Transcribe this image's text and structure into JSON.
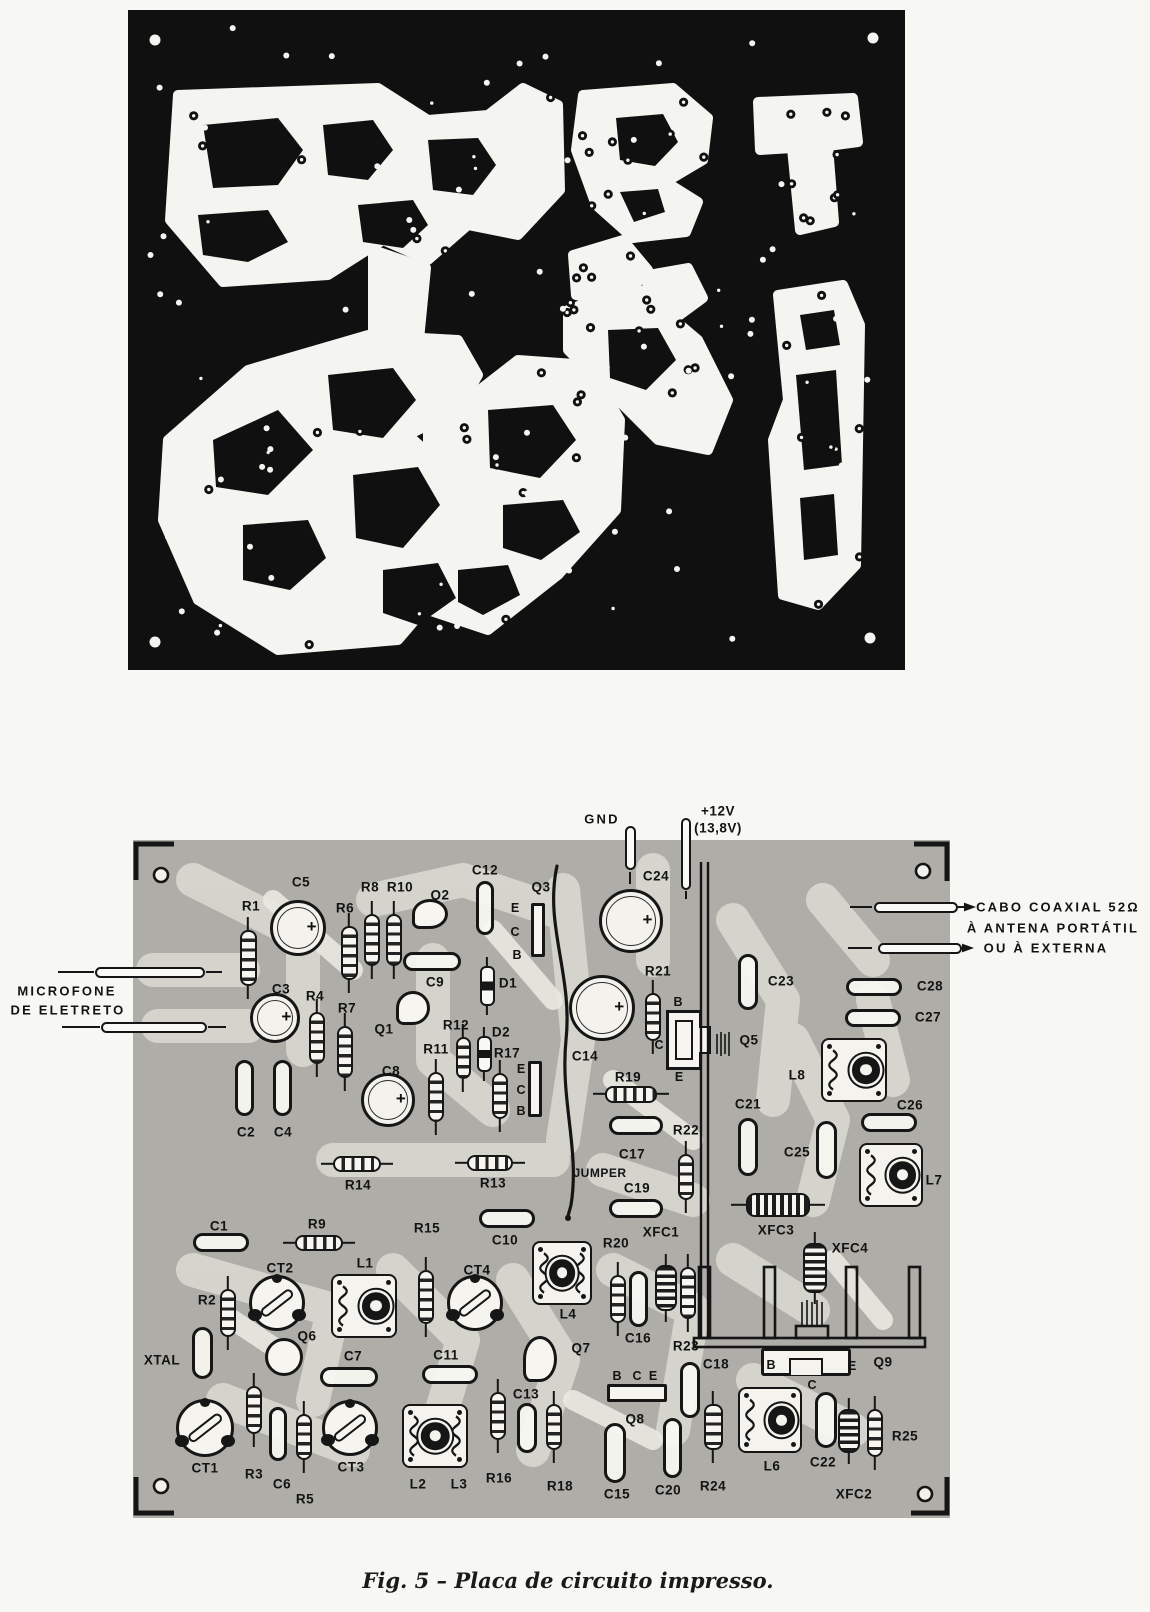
{
  "figure": {
    "caption": "Fig. 5 – Placa de circuito impresso."
  },
  "colors": {
    "pcb_black": "#101010",
    "trace_white": "#f4f4f0",
    "board_gray": "#aeada7",
    "ghost_trace": "#d9d8d1",
    "ink": "#161616",
    "paper": "#f7f7f4"
  },
  "annotations": {
    "ground": "GND",
    "supply": "+12V",
    "supply_alt": "(13,8V)",
    "microphone_line1": "MICROFONE",
    "microphone_line2": "DE ELETRETO",
    "coax_line1": "CABO COAXIAL 52Ω",
    "coax_line2": "À ANTENA PORTÁTIL",
    "coax_line3": "OU À EXTERNA",
    "jumper": "JUMPER",
    "crystal": "XTAL"
  },
  "board": {
    "components": [
      {
        "label": "R1",
        "type": "resistor-v",
        "x": 248,
        "y": 958,
        "w": 17,
        "h": 56,
        "lx": 251,
        "ly": 906
      },
      {
        "label": "C5",
        "type": "cap-el",
        "x": 298,
        "y": 928,
        "w": 56,
        "h": 56,
        "lx": 301,
        "ly": 882
      },
      {
        "label": "R6",
        "type": "resistor-v",
        "x": 349,
        "y": 953,
        "w": 17,
        "h": 54,
        "lx": 345,
        "ly": 908
      },
      {
        "label": "R8",
        "type": "resistor-v",
        "x": 372,
        "y": 940,
        "w": 16,
        "h": 52,
        "lx": 370,
        "ly": 887
      },
      {
        "label": "R10",
        "type": "resistor-v",
        "x": 394,
        "y": 940,
        "w": 16,
        "h": 52,
        "lx": 400,
        "ly": 887
      },
      {
        "label": "Q2",
        "type": "transistor",
        "x": 430,
        "y": 914,
        "w": 36,
        "h": 30,
        "lx": 440,
        "ly": 895
      },
      {
        "label": "C12",
        "type": "cap-sm-v",
        "x": 485,
        "y": 908,
        "w": 18,
        "h": 54,
        "lx": 485,
        "ly": 870
      },
      {
        "label": "Q3",
        "type": "q-rect-v",
        "x": 538,
        "y": 930,
        "w": 14,
        "h": 54,
        "lx": 541,
        "ly": 887
      },
      {
        "label": "C9",
        "type": "cap-sm-h",
        "x": 432,
        "y": 961,
        "w": 58,
        "h": 19,
        "lx": 435,
        "ly": 982
      },
      {
        "label": "D1",
        "type": "diode-v",
        "x": 487,
        "y": 986,
        "w": 15,
        "h": 40,
        "lx": 508,
        "ly": 983
      },
      {
        "label": "Q1",
        "type": "transistor",
        "x": 413,
        "y": 1008,
        "w": 34,
        "h": 34,
        "lx": 384,
        "ly": 1029
      },
      {
        "label": "C3",
        "type": "cap-el",
        "x": 275,
        "y": 1018,
        "w": 50,
        "h": 50,
        "lx": 281,
        "ly": 989
      },
      {
        "label": "R4",
        "type": "resistor-v",
        "x": 317,
        "y": 1038,
        "w": 16,
        "h": 52,
        "lx": 315,
        "ly": 996
      },
      {
        "label": "R7",
        "type": "resistor-v",
        "x": 345,
        "y": 1052,
        "w": 16,
        "h": 52,
        "lx": 347,
        "ly": 1008
      },
      {
        "label": "R12",
        "type": "resistor-v",
        "x": 463,
        "y": 1058,
        "w": 15,
        "h": 42,
        "lx": 456,
        "ly": 1025
      },
      {
        "label": "D2",
        "type": "diode-v",
        "x": 484,
        "y": 1054,
        "w": 15,
        "h": 36,
        "lx": 501,
        "ly": 1032
      },
      {
        "label": "R11",
        "type": "resistor-v",
        "x": 436,
        "y": 1097,
        "w": 16,
        "h": 50,
        "lx": 436,
        "ly": 1049
      },
      {
        "label": "R17",
        "type": "resistor-v",
        "x": 500,
        "y": 1096,
        "w": 16,
        "h": 46,
        "lx": 507,
        "ly": 1053
      },
      {
        "label": "",
        "id": "q4-outline",
        "type": "q-rect-v",
        "x": 535,
        "y": 1089,
        "w": 14,
        "h": 56
      },
      {
        "label": "C8",
        "type": "cap-el",
        "x": 388,
        "y": 1100,
        "w": 54,
        "h": 54,
        "lx": 391,
        "ly": 1071
      },
      {
        "label": "C2",
        "type": "cap-sm-v",
        "x": 244,
        "y": 1088,
        "w": 19,
        "h": 56,
        "lx": 246,
        "ly": 1132
      },
      {
        "label": "C4",
        "type": "cap-sm-v",
        "x": 282,
        "y": 1088,
        "w": 19,
        "h": 56,
        "lx": 283,
        "ly": 1132
      },
      {
        "label": "R14",
        "type": "resistor-h",
        "x": 357,
        "y": 1164,
        "w": 48,
        "h": 16,
        "lx": 358,
        "ly": 1185
      },
      {
        "label": "R13",
        "type": "resistor-h",
        "x": 490,
        "y": 1163,
        "w": 46,
        "h": 16,
        "lx": 493,
        "ly": 1183
      },
      {
        "label": "C24",
        "type": "cap-el",
        "x": 631,
        "y": 921,
        "w": 64,
        "h": 64,
        "lx": 656,
        "ly": 876
      },
      {
        "label": "C14",
        "type": "cap-el",
        "x": 602,
        "y": 1008,
        "w": 66,
        "h": 66,
        "lx": 585,
        "ly": 1056
      },
      {
        "label": "R21",
        "type": "resistor-v",
        "x": 653,
        "y": 1017,
        "w": 16,
        "h": 48,
        "lx": 658,
        "ly": 971
      },
      {
        "label": "R19",
        "type": "resistor-h",
        "x": 631,
        "y": 1094,
        "w": 52,
        "h": 17,
        "lx": 628,
        "ly": 1077
      },
      {
        "label": "C23",
        "type": "cap-sm-v",
        "x": 748,
        "y": 982,
        "w": 20,
        "h": 56,
        "lx": 781,
        "ly": 981
      },
      {
        "label": "C28",
        "type": "cap-sm-h",
        "x": 874,
        "y": 987,
        "w": 56,
        "h": 18,
        "lx": 930,
        "ly": 986
      },
      {
        "label": "C27",
        "type": "cap-sm-h",
        "x": 873,
        "y": 1018,
        "w": 56,
        "h": 18,
        "lx": 928,
        "ly": 1017
      },
      {
        "label": "L8",
        "type": "coil-can",
        "x": 854,
        "y": 1070,
        "w": 66,
        "h": 64,
        "lx": 797,
        "ly": 1075
      },
      {
        "label": "C26",
        "type": "cap-sm-h",
        "x": 889,
        "y": 1122,
        "w": 56,
        "h": 19,
        "lx": 910,
        "ly": 1105
      },
      {
        "label": "C21",
        "type": "cap-sm-v",
        "x": 748,
        "y": 1147,
        "w": 20,
        "h": 58,
        "lx": 748,
        "ly": 1104
      },
      {
        "label": "C25",
        "type": "cap-sm-v",
        "x": 826,
        "y": 1150,
        "w": 21,
        "h": 58,
        "lx": 797,
        "ly": 1152
      },
      {
        "label": "L7",
        "type": "coil-can",
        "x": 891,
        "y": 1175,
        "w": 64,
        "h": 64,
        "lx": 934,
        "ly": 1180
      },
      {
        "label": "C17",
        "type": "cap-sm-h",
        "x": 636,
        "y": 1125,
        "w": 54,
        "h": 19,
        "lx": 632,
        "ly": 1154
      },
      {
        "label": "JUMPER",
        "lx": 600,
        "ly": 1173,
        "cls": "small"
      },
      {
        "label": "C19",
        "type": "cap-sm-h",
        "x": 636,
        "y": 1208,
        "w": 54,
        "h": 19,
        "lx": 637,
        "ly": 1188
      },
      {
        "label": "R22",
        "type": "resistor-v",
        "x": 686,
        "y": 1177,
        "w": 16,
        "h": 46,
        "lx": 686,
        "ly": 1130
      },
      {
        "label": "C10",
        "type": "cap-sm-h",
        "x": 507,
        "y": 1218,
        "w": 56,
        "h": 19,
        "lx": 505,
        "ly": 1240
      },
      {
        "label": "C1",
        "type": "cap-sm-h",
        "x": 221,
        "y": 1242,
        "w": 56,
        "h": 19,
        "lx": 219,
        "ly": 1226
      },
      {
        "label": "R9",
        "type": "resistor-h",
        "x": 319,
        "y": 1243,
        "w": 48,
        "h": 16,
        "lx": 317,
        "ly": 1224
      },
      {
        "label": "R15",
        "type": "resistor-v",
        "x": 426,
        "y": 1297,
        "w": 16,
        "h": 54,
        "lx": 427,
        "ly": 1228
      },
      {
        "label": "L4",
        "type": "coil-can-double",
        "x": 562,
        "y": 1273,
        "w": 60,
        "h": 64,
        "lx": 568,
        "ly": 1314
      },
      {
        "label": "CT2",
        "type": "trimmer",
        "x": 277,
        "y": 1303,
        "w": 56,
        "h": 56,
        "lx": 280,
        "ly": 1268
      },
      {
        "label": "L1",
        "type": "coil-can",
        "x": 364,
        "y": 1306,
        "w": 66,
        "h": 64,
        "lx": 365,
        "ly": 1263
      },
      {
        "label": "CT4",
        "type": "trimmer",
        "x": 475,
        "y": 1303,
        "w": 56,
        "h": 56,
        "lx": 477,
        "ly": 1270
      },
      {
        "label": "R2",
        "type": "resistor-v",
        "x": 228,
        "y": 1313,
        "w": 16,
        "h": 48,
        "lx": 207,
        "ly": 1300
      },
      {
        "label": "XTAL",
        "type": "xtal",
        "x": 202,
        "y": 1353,
        "w": 21,
        "h": 52,
        "lx": 162,
        "ly": 1360
      },
      {
        "label": "Q6",
        "type": "transistor-round",
        "x": 284,
        "y": 1357,
        "w": 38,
        "h": 38,
        "lx": 307,
        "ly": 1336
      },
      {
        "label": "C7",
        "type": "cap-sm-h",
        "x": 349,
        "y": 1377,
        "w": 58,
        "h": 20,
        "lx": 353,
        "ly": 1356
      },
      {
        "label": "C11",
        "type": "cap-sm-h",
        "x": 450,
        "y": 1374,
        "w": 56,
        "h": 19,
        "lx": 446,
        "ly": 1355
      },
      {
        "label": "Q7",
        "type": "transistor",
        "x": 540,
        "y": 1359,
        "w": 34,
        "h": 46,
        "lx": 581,
        "ly": 1348
      },
      {
        "label": "C13",
        "type": "cap-sm-v",
        "x": 527,
        "y": 1428,
        "w": 20,
        "h": 50,
        "lx": 526,
        "ly": 1394
      },
      {
        "label": "CT1",
        "type": "trimmer",
        "x": 205,
        "y": 1428,
        "w": 58,
        "h": 58,
        "lx": 205,
        "ly": 1468
      },
      {
        "label": "R3",
        "type": "resistor-v",
        "x": 254,
        "y": 1410,
        "w": 16,
        "h": 48,
        "lx": 254,
        "ly": 1474
      },
      {
        "label": "C6",
        "type": "cap-sm-v",
        "x": 278,
        "y": 1434,
        "w": 18,
        "h": 54,
        "lx": 282,
        "ly": 1484
      },
      {
        "label": "R5",
        "type": "resistor-v",
        "x": 304,
        "y": 1437,
        "w": 16,
        "h": 46,
        "lx": 305,
        "ly": 1499
      },
      {
        "label": "CT3",
        "type": "trimmer",
        "x": 350,
        "y": 1428,
        "w": 56,
        "h": 56,
        "lx": 351,
        "ly": 1467
      },
      {
        "label": "L2",
        "type": "coil-can-double",
        "x": 435,
        "y": 1436,
        "w": 66,
        "h": 64,
        "lx": 418,
        "ly": 1484
      },
      {
        "label": "L3",
        "lx": 459,
        "ly": 1484
      },
      {
        "label": "R16",
        "type": "resistor-v",
        "x": 498,
        "y": 1416,
        "w": 16,
        "h": 48,
        "lx": 499,
        "ly": 1478
      },
      {
        "label": "R18",
        "type": "resistor-v",
        "x": 554,
        "y": 1427,
        "w": 16,
        "h": 46,
        "lx": 560,
        "ly": 1486
      },
      {
        "label": "Q8",
        "type": "q-rect-h",
        "x": 637,
        "y": 1393,
        "w": 60,
        "h": 18,
        "lx": 635,
        "ly": 1419
      },
      {
        "label": "C15",
        "type": "cap-sm-v",
        "x": 615,
        "y": 1453,
        "w": 22,
        "h": 60,
        "lx": 617,
        "ly": 1494
      },
      {
        "label": "C20",
        "type": "cap-sm-v",
        "x": 672,
        "y": 1448,
        "w": 19,
        "h": 60,
        "lx": 668,
        "ly": 1490
      },
      {
        "label": "R24",
        "type": "resistor-v",
        "x": 713,
        "y": 1427,
        "w": 19,
        "h": 46,
        "lx": 713,
        "ly": 1486
      },
      {
        "label": "C18",
        "type": "cap-sm-v",
        "x": 690,
        "y": 1390,
        "w": 20,
        "h": 56,
        "lx": 716,
        "ly": 1364
      },
      {
        "label": "L6",
        "type": "coil-can",
        "x": 770,
        "y": 1420,
        "w": 64,
        "h": 66,
        "lx": 772,
        "ly": 1466
      },
      {
        "label": "C22",
        "type": "cap-sm-v",
        "x": 826,
        "y": 1420,
        "w": 22,
        "h": 56,
        "lx": 823,
        "ly": 1462
      },
      {
        "label": "XFC2",
        "type": "choke-v",
        "x": 849,
        "y": 1431,
        "w": 22,
        "h": 44,
        "lx": 854,
        "ly": 1494
      },
      {
        "label": "R25",
        "type": "resistor-v",
        "x": 875,
        "y": 1433,
        "w": 16,
        "h": 48,
        "lx": 905,
        "ly": 1436
      },
      {
        "label": "Q9",
        "type": "power-q9",
        "x": 806,
        "y": 1362,
        "w": 90,
        "h": 28,
        "lx": 883,
        "ly": 1362
      },
      {
        "label": "XFC1",
        "type": "choke-v",
        "x": 666,
        "y": 1288,
        "w": 22,
        "h": 46,
        "lx": 661,
        "ly": 1232
      },
      {
        "label": "R20",
        "type": "resistor-v",
        "x": 618,
        "y": 1299,
        "w": 16,
        "h": 48,
        "lx": 616,
        "ly": 1243
      },
      {
        "label": "C16",
        "type": "cap-sm-v",
        "x": 638,
        "y": 1299,
        "w": 19,
        "h": 56,
        "lx": 638,
        "ly": 1338
      },
      {
        "label": "R23",
        "type": "resistor-v",
        "x": 688,
        "y": 1293,
        "w": 16,
        "h": 52,
        "lx": 686,
        "ly": 1346
      },
      {
        "label": "XFC3",
        "type": "choke-h",
        "x": 778,
        "y": 1205,
        "w": 64,
        "h": 24,
        "lx": 776,
        "ly": 1230
      },
      {
        "label": "XFC4",
        "type": "choke-v",
        "x": 815,
        "y": 1268,
        "w": 24,
        "h": 50,
        "lx": 850,
        "ly": 1248
      },
      {
        "label": "Q5",
        "type": "power-tab",
        "x": 684,
        "y": 1040,
        "w": 36,
        "h": 60,
        "lx": 749,
        "ly": 1040
      },
      {
        "label": "GND",
        "type": "pin-v",
        "x": 630,
        "y": 848,
        "w": 11,
        "h": 44,
        "lx": 602,
        "ly": 819,
        "cls": "ann"
      },
      {
        "label": "+12V",
        "type": "pin-v",
        "x": 686,
        "y": 854,
        "w": 10,
        "h": 72,
        "lx": 718,
        "ly": 811
      },
      {
        "label": "(13,8V)",
        "lx": 718,
        "ly": 828
      },
      {
        "label": "",
        "id": "mic-lead-1",
        "type": "lead-h",
        "x": 150,
        "y": 972,
        "w": 110,
        "h": 11
      },
      {
        "label": "",
        "id": "mic-lead-2",
        "type": "lead-h",
        "x": 154,
        "y": 1027,
        "w": 106,
        "h": 11
      },
      {
        "label": "",
        "id": "coax-lead-1",
        "type": "lead-h",
        "x": 916,
        "y": 907,
        "w": 84,
        "h": 11
      },
      {
        "label": "",
        "id": "coax-lead-2",
        "type": "lead-h",
        "x": 920,
        "y": 948,
        "w": 84,
        "h": 11
      },
      {
        "label": "MICROFONE",
        "lx": 67,
        "ly": 991,
        "cls": "ann"
      },
      {
        "label": "DE ELETRETO",
        "lx": 68,
        "ly": 1010,
        "cls": "ann"
      },
      {
        "label": "CABO COAXIAL 52Ω",
        "lx": 1058,
        "ly": 907,
        "cls": "ann"
      },
      {
        "label": "À ANTENA PORTÁTIL",
        "lx": 1053,
        "ly": 928,
        "cls": "ann"
      },
      {
        "label": "OU À EXTERNA",
        "lx": 1046,
        "ly": 948,
        "cls": "ann"
      }
    ],
    "pin_labels": [
      {
        "label": "E",
        "x": 515,
        "y": 908
      },
      {
        "label": "C",
        "x": 515,
        "y": 932
      },
      {
        "label": "B",
        "x": 517,
        "y": 955
      },
      {
        "label": "E",
        "x": 521,
        "y": 1069
      },
      {
        "label": "C",
        "x": 521,
        "y": 1090
      },
      {
        "label": "B",
        "x": 521,
        "y": 1111
      },
      {
        "label": "B",
        "x": 678,
        "y": 1002
      },
      {
        "label": "C",
        "x": 659,
        "y": 1045
      },
      {
        "label": "E",
        "x": 679,
        "y": 1077
      },
      {
        "label": "B",
        "x": 617,
        "y": 1376
      },
      {
        "label": "C",
        "x": 637,
        "y": 1376
      },
      {
        "label": "E",
        "x": 653,
        "y": 1376
      },
      {
        "label": "B",
        "x": 771,
        "y": 1365
      },
      {
        "label": "E",
        "x": 852,
        "y": 1366
      },
      {
        "label": "C",
        "x": 812,
        "y": 1385
      }
    ]
  }
}
